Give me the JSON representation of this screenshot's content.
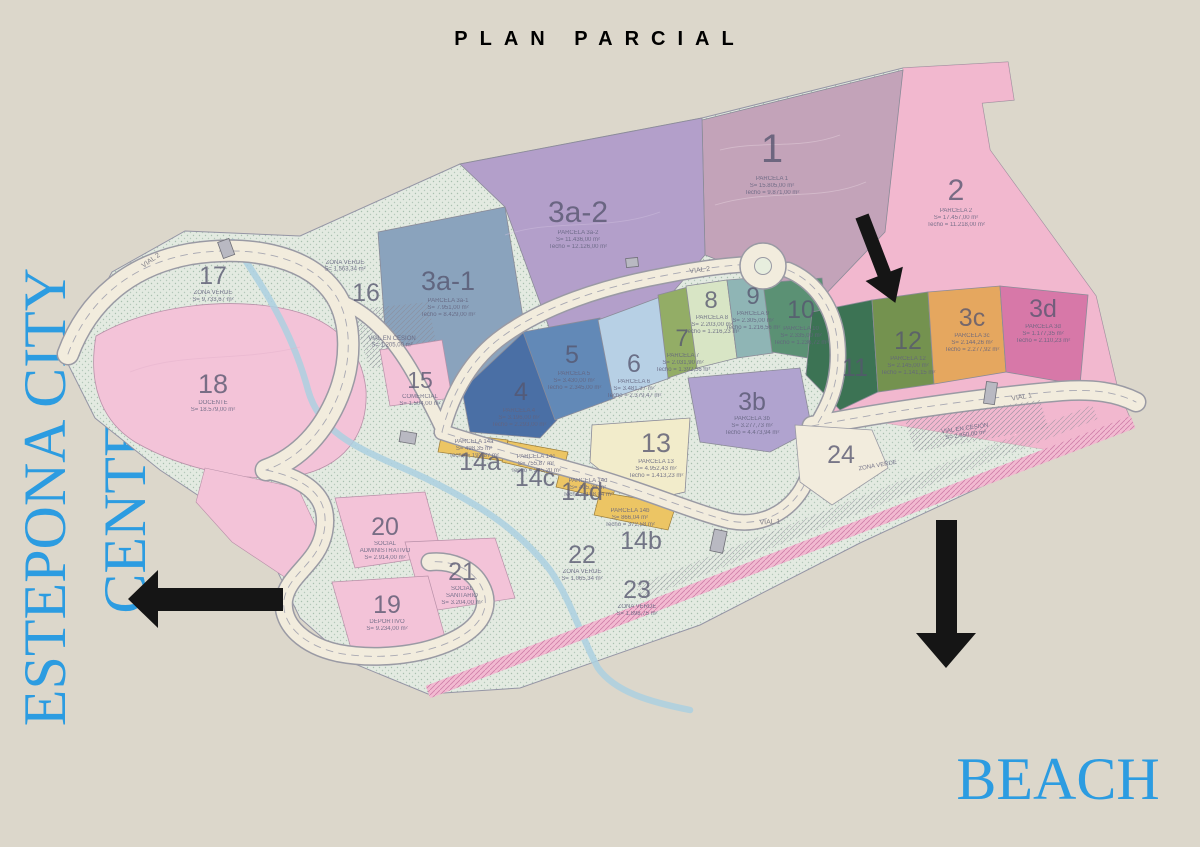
{
  "title": "PLAN PARCIAL",
  "labels": {
    "left": "ESTEPONA CITY CENTER",
    "beach": "BEACH"
  },
  "colors": {
    "background": "#dcd7cb",
    "accent_blue": "#2c9ce1",
    "arrow": "#151515",
    "green_zone": "#e3eae1",
    "road": "#f2ecdd",
    "road_edge": "#9a9aa4",
    "stream": "#abd0e0",
    "pink": "#f3c3d8",
    "pink_band": "#f2b8cf",
    "mauve": "#c3a3b9",
    "violet": "#b39fca",
    "violet2": "#b0a3cf",
    "steel": "#8aa3bd",
    "blue_dark": "#4a6fa5",
    "blue_mid": "#6289b7",
    "blue_light": "#b7d0e5",
    "olive": "#93ad66",
    "pale_green": "#d8e5c5",
    "teal": "#8fb5b5",
    "green_mid": "#5b9174",
    "green_dark": "#3c7354",
    "olive2": "#74924f",
    "orange": "#e5a75f",
    "magenta": "#d778a8",
    "cream": "#f2eccb",
    "gold": "#ecc564",
    "bridge": "#b9b9c2",
    "label": "#56566f"
  },
  "parcels": {
    "p1": {
      "num": "1",
      "name": "PARCELA 1",
      "s": "S= 15.805,00 m²",
      "t": "Techo = 9.871,00 m²"
    },
    "p2": {
      "num": "2",
      "name": "PARCELA 2",
      "s": "S= 17.457,00 m²",
      "t": "Techo = 11.218,00 m²"
    },
    "p3a1": {
      "num": "3a-1",
      "name": "PARCELA 3a-1",
      "s": "S= 7.951,00 m²",
      "t": "Techo = 8.429,00 m²"
    },
    "p3a2": {
      "num": "3a-2",
      "name": "PARCELA 3a-2",
      "s": "S= 11.436,00 m²",
      "t": "Techo = 12.126,00 m²"
    },
    "p3b": {
      "num": "3b",
      "name": "PARCELA 3b",
      "s": "S= 3.277,73 m²",
      "t": "Techo = 4.473,94 m²"
    },
    "p3c": {
      "num": "3c",
      "name": "PARCELA 3c",
      "s": "S= 2.144,26 m²",
      "t": "Techo = 2.277,92 m²"
    },
    "p3d": {
      "num": "3d",
      "name": "PARCELA 3d",
      "s": "S= 1.177,35 m²",
      "t": "Techo = 2.110,23 m²"
    },
    "p4": {
      "num": "4",
      "name": "PARCELA 4",
      "s": "S= 3.196,00 m²",
      "t": "Techo = 2.293,00 m²"
    },
    "p5": {
      "num": "5",
      "name": "PARCELA 5",
      "s": "S= 3.430,00 m²",
      "t": "Techo = 2.345,00 m²"
    },
    "p6": {
      "num": "6",
      "name": "PARCELA 6",
      "s": "S= 3.481,37 m²",
      "t": "Techo = 2.379,47 m²"
    },
    "p7": {
      "num": "7",
      "name": "PARCELA 7",
      "s": "S= 2.031,90 m²",
      "t": "Techo = 1.392,56 m²"
    },
    "p8": {
      "num": "8",
      "name": "PARCELA 8",
      "s": "S= 2.203,00 m²",
      "t": "Techo = 1.216,23 m²"
    },
    "p9": {
      "num": "9",
      "name": "PARCELA 9",
      "s": "S= 2.305,00 m²",
      "t": "Techo = 1.216,56 m²"
    },
    "p10": {
      "num": "10",
      "name": "PARCELA 10",
      "s": "S= 2.335,00 m²",
      "t": "Techo = 1.236,72 m²"
    },
    "p11": {
      "num": "11"
    },
    "p12": {
      "num": "12",
      "name": "PARCELA 12",
      "s": "S= 2.145,00 m²",
      "t": "Techo = 1.141,15 m²"
    },
    "p13": {
      "num": "13",
      "name": "PARCELA 13",
      "s": "S= 4.952,43 m²",
      "t": "Techo = 1.413,23 m²"
    },
    "p14a": {
      "num": "14a",
      "name": "PARCELA 14a",
      "s": "S= 498,35 m²",
      "t": "Techo = 193,87 m²"
    },
    "p14b": {
      "num": "14b",
      "name": "PARCELA 14b",
      "s": "S= 866,04 m²",
      "t": "Techo = 372,58 m²"
    },
    "p14c": {
      "num": "14c",
      "name": "PARCELA 14c",
      "s": "S= 755,87 m²",
      "t": "Techo = 295,20 m²"
    },
    "p14d": {
      "num": "14d",
      "name": "PARCELA 14d",
      "s": "S= 405,32 m²",
      "t": "Techo = 158,04 m²"
    },
    "p15": {
      "num": "15",
      "name": "COMERCIAL",
      "s": "S= 1.504,00 m²"
    },
    "p16": {
      "num": "16"
    },
    "p17": {
      "num": "17",
      "name": "ZONA VERDE",
      "s": "S= 9.733,67 m²"
    },
    "p18": {
      "num": "18",
      "name": "DOCENTE",
      "s": "S= 18.579,00 m²"
    },
    "p19": {
      "num": "19",
      "name": "DEPORTIVO",
      "s": "S= 9.234,00 m²"
    },
    "p20": {
      "num": "20",
      "n1": "SOCIAL",
      "n2": "ADMINISTRATIVO",
      "s": "S= 2.914,00 m²"
    },
    "p21": {
      "num": "21",
      "n1": "SOCIAL",
      "n2": "SANITARIO",
      "s": "S= 3.204,00 m²"
    },
    "p22": {
      "num": "22",
      "name": "ZONA VERDE",
      "s": "S= 1.065,34 m²"
    },
    "p23": {
      "num": "23",
      "name": "ZONA VERDE",
      "s": "S= 1.898,75 m²"
    },
    "p24": {
      "num": "24"
    }
  },
  "zones": {
    "z16": {
      "name": "ZONA VERDE",
      "s": "S= 1.563,34 m²"
    },
    "cesL": {
      "name": "VIAL EN CESIÓN",
      "s": "S= 1.205,00 m²"
    },
    "cesR": {
      "name": "VIAL EN CESIÓN",
      "s": "S= 2.850,00 m²"
    },
    "zvR": {
      "name": "ZONA VERDE"
    }
  },
  "roads": {
    "vial1": "VIAL 1",
    "vial2": "VIAL 2"
  }
}
